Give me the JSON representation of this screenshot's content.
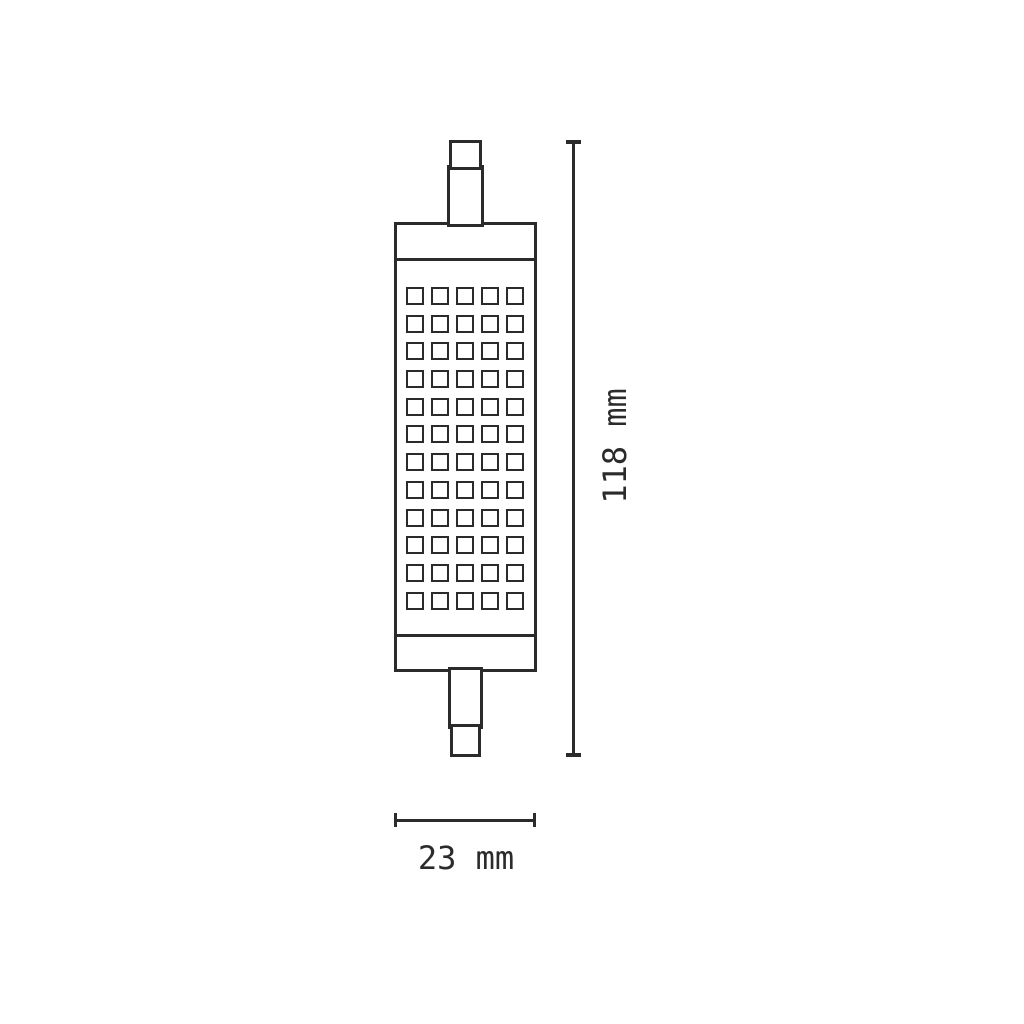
{
  "dimensions": {
    "height": {
      "label": "118 mm"
    },
    "width": {
      "label": "23 mm"
    }
  },
  "lamp": {
    "grid_rows": 12,
    "grid_cols": 5
  },
  "colors": {
    "line": "#2b2b2b",
    "background": "#ffffff"
  }
}
